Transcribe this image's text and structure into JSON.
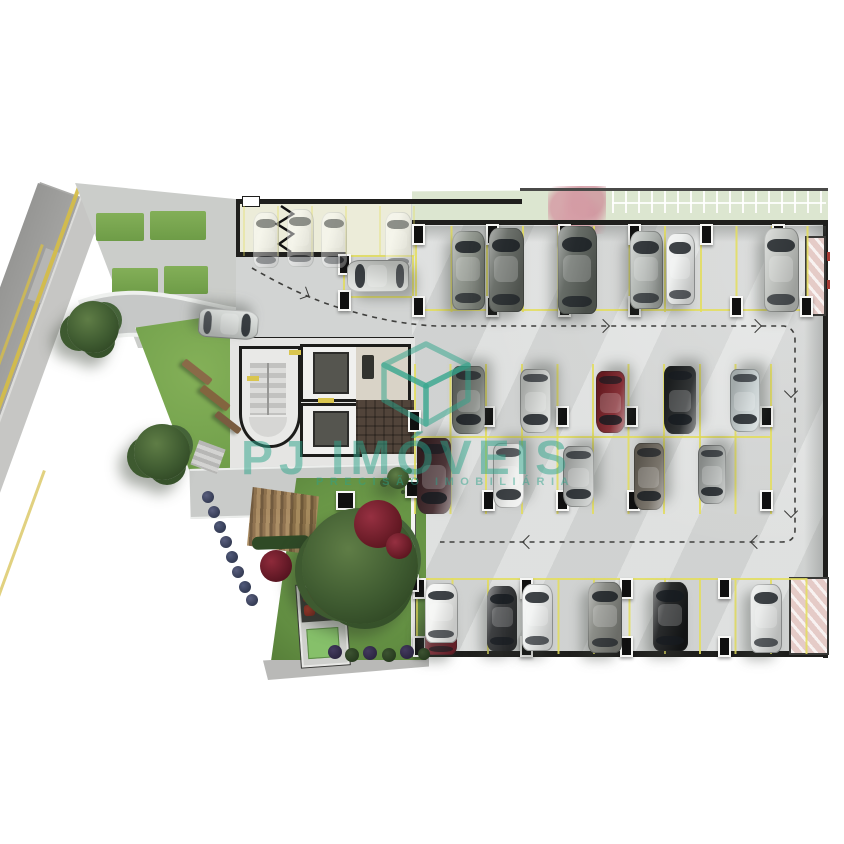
{
  "watermark": {
    "brand": "PJ IMÓVEIS",
    "tagline": "PRECISÃO IMOBILIÁRIA",
    "color": "#2ca489"
  },
  "palette": {
    "background": "#ffffff",
    "concrete": "#d8dad9",
    "street": "#9e9e9c",
    "grass": "#74a24d",
    "parking_line_yellow": "#e4de5c",
    "wall": "#1f1f1d",
    "watermark_teal": "#2ca489",
    "ramp_pink": "#e5cbc7"
  },
  "scene": {
    "parking_rows": [
      {
        "x": 415,
        "y": 226,
        "w": 394,
        "h": 86,
        "sp": 35.6,
        "a": 0.85
      },
      {
        "x": 414,
        "y": 364,
        "w": 358,
        "h": 150,
        "sp": 35.6,
        "a": 0.85
      },
      {
        "x": 416,
        "y": 578,
        "w": 392,
        "h": 76,
        "sp": 35.4,
        "a": 0.85
      },
      {
        "x": 243,
        "y": 206,
        "w": 172,
        "h": 50,
        "sp": 34,
        "a": 0.35
      }
    ],
    "lines": [
      {
        "x": 415,
        "y": 309,
        "w": 392,
        "h": 2
      },
      {
        "x": 414,
        "y": 436,
        "w": 356,
        "h": 2
      },
      {
        "x": 416,
        "y": 578,
        "w": 390,
        "h": 2
      },
      {
        "x": 344,
        "y": 255,
        "w": 70,
        "h": 2
      },
      {
        "x": 344,
        "y": 296,
        "w": 70,
        "h": 2
      },
      {
        "x": 343,
        "y": 255,
        "w": 2,
        "h": 43
      },
      {
        "x": 412,
        "y": 255,
        "w": 2,
        "h": 43
      }
    ],
    "pillars": [
      {
        "x": 412,
        "y": 224
      },
      {
        "x": 486,
        "y": 224
      },
      {
        "x": 558,
        "y": 224
      },
      {
        "x": 628,
        "y": 224
      },
      {
        "x": 700,
        "y": 224
      },
      {
        "x": 772,
        "y": 224
      },
      {
        "x": 412,
        "y": 296
      },
      {
        "x": 486,
        "y": 296
      },
      {
        "x": 558,
        "y": 296
      },
      {
        "x": 628,
        "y": 296
      },
      {
        "x": 730,
        "y": 296
      },
      {
        "x": 800,
        "y": 296
      },
      {
        "x": 482,
        "y": 406
      },
      {
        "x": 556,
        "y": 406
      },
      {
        "x": 625,
        "y": 406
      },
      {
        "x": 760,
        "y": 406
      },
      {
        "x": 482,
        "y": 490
      },
      {
        "x": 556,
        "y": 490
      },
      {
        "x": 627,
        "y": 490
      },
      {
        "x": 760,
        "y": 490
      },
      {
        "x": 413,
        "y": 578
      },
      {
        "x": 520,
        "y": 578
      },
      {
        "x": 620,
        "y": 578
      },
      {
        "x": 718,
        "y": 578
      },
      {
        "x": 413,
        "y": 636
      },
      {
        "x": 520,
        "y": 636
      },
      {
        "x": 620,
        "y": 636
      },
      {
        "x": 718,
        "y": 636
      },
      {
        "x": 338,
        "y": 254
      },
      {
        "x": 338,
        "y": 290
      },
      {
        "x": 408,
        "y": 410,
        "h": 18
      },
      {
        "x": 405,
        "y": 480,
        "w": 10,
        "h": 14
      },
      {
        "x": 405,
        "y": 574,
        "w": 10,
        "h": 14
      },
      {
        "x": 336,
        "y": 491,
        "w": 15,
        "h": 15
      }
    ],
    "ghost_cars": [
      {
        "name": "ghost-car",
        "cx": 266,
        "cy": 240,
        "len": 56,
        "wid": 26,
        "angle": 0,
        "color": "rgba(255,255,255,0.78)"
      },
      {
        "name": "ghost-car",
        "cx": 300,
        "cy": 238,
        "len": 58,
        "wid": 27,
        "angle": 0,
        "color": "rgba(255,255,255,0.78)"
      },
      {
        "name": "ghost-car",
        "cx": 334,
        "cy": 240,
        "len": 56,
        "wid": 26,
        "angle": 0,
        "color": "rgba(255,255,255,0.72)"
      },
      {
        "name": "ghost-car",
        "cx": 398,
        "cy": 241,
        "len": 58,
        "wid": 27,
        "angle": 0,
        "color": "rgba(255,255,255,0.78)"
      }
    ],
    "cars": [
      {
        "name": "car-sedan-gray-green",
        "cx": 468,
        "cy": 270,
        "len": 79,
        "wid": 33,
        "angle": 0,
        "color": "#8d938a"
      },
      {
        "name": "car-suv-dark-gray",
        "cx": 506,
        "cy": 270,
        "len": 84,
        "wid": 35,
        "angle": 0,
        "color": "#60655f"
      },
      {
        "name": "car-suv-dark-large",
        "cx": 577,
        "cy": 270,
        "len": 88,
        "wid": 39,
        "angle": 0,
        "color": "#5a605a"
      },
      {
        "name": "car-suv-silver",
        "cx": 646,
        "cy": 270,
        "len": 78,
        "wid": 33,
        "angle": 0,
        "color": "#b2b7b3"
      },
      {
        "name": "car-compact-white",
        "cx": 680,
        "cy": 269,
        "len": 72,
        "wid": 29,
        "angle": 0,
        "color": "#eceeed"
      },
      {
        "name": "car-suv-light-gray",
        "cx": 781,
        "cy": 270,
        "len": 84,
        "wid": 35,
        "angle": 0,
        "color": "#c0c3bf"
      },
      {
        "name": "car-suv-entrance",
        "cx": 378,
        "cy": 276,
        "len": 62,
        "wid": 32,
        "angle": -90,
        "color": "#d3d6d2"
      },
      {
        "name": "car-driveway-silver",
        "cx": 228,
        "cy": 324,
        "len": 60,
        "wid": 29,
        "angle": 94,
        "color": "#ccd0cd"
      },
      {
        "name": "car-suv-gray",
        "cx": 468,
        "cy": 400,
        "len": 68,
        "wid": 33,
        "angle": 180,
        "color": "#6d726c"
      },
      {
        "name": "car-sedan-silver",
        "cx": 535,
        "cy": 401,
        "len": 64,
        "wid": 31,
        "angle": 180,
        "color": "#cccfcc"
      },
      {
        "name": "car-sedan-dark-red",
        "cx": 610,
        "cy": 402,
        "len": 62,
        "wid": 29,
        "angle": 180,
        "color": "#7c2027"
      },
      {
        "name": "car-sedan-black",
        "cx": 680,
        "cy": 400,
        "len": 68,
        "wid": 32,
        "angle": 180,
        "color": "#212425"
      },
      {
        "name": "car-classic-light-blue",
        "cx": 745,
        "cy": 400,
        "len": 63,
        "wid": 30,
        "angle": 180,
        "color": "#c6cfd0"
      },
      {
        "name": "car-sedan-dark-maroon",
        "cx": 434,
        "cy": 476,
        "len": 76,
        "wid": 34,
        "angle": 180,
        "color": "#3c2326"
      },
      {
        "name": "car-sedan-white",
        "cx": 508,
        "cy": 475,
        "len": 65,
        "wid": 31,
        "angle": 180,
        "color": "#ebecea"
      },
      {
        "name": "car-suv-silver-2",
        "cx": 578,
        "cy": 476,
        "len": 61,
        "wid": 31,
        "angle": 180,
        "color": "#babdbb"
      },
      {
        "name": "car-suv-brown-gray",
        "cx": 649,
        "cy": 476,
        "len": 67,
        "wid": 30,
        "angle": 180,
        "color": "#6f695f"
      },
      {
        "name": "car-suv-gray-compact",
        "cx": 712,
        "cy": 474,
        "len": 59,
        "wid": 28,
        "angle": 180,
        "color": "#a3a7a5"
      },
      {
        "name": "car-red-tucked",
        "cx": 441,
        "cy": 634,
        "len": 42,
        "wid": 32,
        "angle": 0,
        "color": "#7e2430"
      },
      {
        "name": "car-white-front",
        "cx": 441,
        "cy": 613,
        "len": 60,
        "wid": 33,
        "angle": 0,
        "color": "#f2f3f1"
      },
      {
        "name": "car-sedan-black-2",
        "cx": 502,
        "cy": 618,
        "len": 65,
        "wid": 30,
        "angle": 0,
        "color": "#2e3032"
      },
      {
        "name": "car-sedan-white-2",
        "cx": 537,
        "cy": 617,
        "len": 67,
        "wid": 31,
        "angle": 0,
        "color": "#eff1f0"
      },
      {
        "name": "car-suv-gray-2",
        "cx": 605,
        "cy": 617,
        "len": 71,
        "wid": 34,
        "angle": 0,
        "color": "#82847e"
      },
      {
        "name": "car-sedan-black-3",
        "cx": 670,
        "cy": 616,
        "len": 69,
        "wid": 35,
        "angle": 0,
        "color": "#17191a"
      },
      {
        "name": "car-sedan-silver-3",
        "cx": 766,
        "cy": 618,
        "len": 69,
        "wid": 32,
        "angle": 0,
        "color": "#e2e4e3"
      }
    ],
    "trees": [
      {
        "name": "street-tree",
        "cx": 93,
        "cy": 327,
        "r": 26
      },
      {
        "name": "sidewalk-tree",
        "cx": 162,
        "cy": 452,
        "r": 28
      },
      {
        "name": "garden-tree-large",
        "cx": 360,
        "cy": 566,
        "r": 58
      },
      {
        "name": "garden-bush",
        "cx": 398,
        "cy": 478,
        "r": 11
      }
    ],
    "shrubs": [
      {
        "name": "red-shrub",
        "cx": 378,
        "cy": 524,
        "r": 24,
        "c1": "#963041",
        "c2": "#5e1620"
      },
      {
        "name": "red-shrub",
        "cx": 399,
        "cy": 546,
        "r": 13,
        "c1": "#963041",
        "c2": "#5e1620"
      },
      {
        "name": "red-shrub",
        "cx": 276,
        "cy": 566,
        "r": 16,
        "c1": "#8e2a3a",
        "c2": "#561420"
      },
      {
        "name": "hedge-shrub",
        "cx": 208,
        "cy": 497,
        "r": 6,
        "c1": "#5a5f7e",
        "c2": "#333a52"
      },
      {
        "name": "hedge-shrub",
        "cx": 214,
        "cy": 512,
        "r": 6,
        "c1": "#5a5f7e",
        "c2": "#333a52"
      },
      {
        "name": "hedge-shrub",
        "cx": 220,
        "cy": 527,
        "r": 6,
        "c1": "#515a7a",
        "c2": "#303850"
      },
      {
        "name": "hedge-shrub",
        "cx": 226,
        "cy": 542,
        "r": 6,
        "c1": "#5a5f7e",
        "c2": "#333a52"
      },
      {
        "name": "hedge-shrub",
        "cx": 232,
        "cy": 557,
        "r": 6,
        "c1": "#515a7a",
        "c2": "#303850"
      },
      {
        "name": "hedge-shrub",
        "cx": 238,
        "cy": 572,
        "r": 6,
        "c1": "#5a5f7e",
        "c2": "#333a52"
      },
      {
        "name": "hedge-shrub",
        "cx": 245,
        "cy": 587,
        "r": 6,
        "c1": "#515a7a",
        "c2": "#303850"
      },
      {
        "name": "hedge-shrub",
        "cx": 252,
        "cy": 600,
        "r": 6,
        "c1": "#5a5f7e",
        "c2": "#333a52"
      },
      {
        "name": "border-shrub",
        "cx": 335,
        "cy": 652,
        "r": 7,
        "c1": "#433a5e",
        "c2": "#2b2440"
      },
      {
        "name": "border-shrub",
        "cx": 352,
        "cy": 655,
        "r": 7,
        "c1": "#3c5231",
        "c2": "#263a1e"
      },
      {
        "name": "border-shrub",
        "cx": 370,
        "cy": 653,
        "r": 7,
        "c1": "#433a5e",
        "c2": "#2b2440"
      },
      {
        "name": "border-shrub",
        "cx": 389,
        "cy": 655,
        "r": 7,
        "c1": "#3c5231",
        "c2": "#263a1e"
      },
      {
        "name": "border-shrub",
        "cx": 407,
        "cy": 652,
        "r": 7,
        "c1": "#433a5e",
        "c2": "#2b2440"
      },
      {
        "name": "border-shrub",
        "cx": 424,
        "cy": 654,
        "r": 6,
        "c1": "#3c5231",
        "c2": "#263a1e"
      }
    ],
    "benches": [
      {
        "x": 180,
        "y": 368,
        "w": 34,
        "h": 8,
        "rot": 38,
        "color": "#8a6a48"
      },
      {
        "x": 198,
        "y": 394,
        "w": 34,
        "h": 8,
        "rot": 38,
        "color": "#83653f"
      },
      {
        "x": 213,
        "y": 419,
        "w": 30,
        "h": 7,
        "rot": 38,
        "color": "#7a5c40"
      }
    ],
    "chevrons": [
      {
        "x": 598,
        "y": 321,
        "rot": -45
      },
      {
        "x": 750,
        "y": 321,
        "rot": -45
      },
      {
        "x": 786,
        "y": 386,
        "rot": 45
      },
      {
        "x": 786,
        "y": 506,
        "rot": 45
      },
      {
        "x": 752,
        "y": 537,
        "rot": 135
      },
      {
        "x": 524,
        "y": 537,
        "rot": 135
      },
      {
        "x": 298,
        "y": 288,
        "rot": -20
      }
    ],
    "dashed_paths": [
      {
        "d": "M 252,268 Q 300,296 340,308 Q 392,324 436,326 L 784,326 Q 795,328 795,340 L 795,530 Q 795,542 782,542 L 440,542"
      }
    ]
  }
}
